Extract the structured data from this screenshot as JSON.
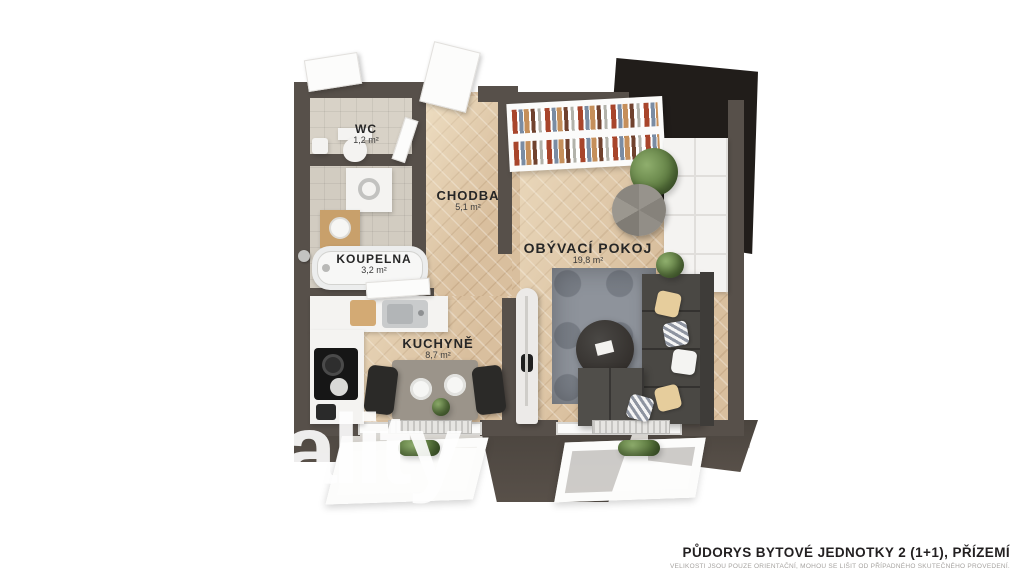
{
  "plan": {
    "watermark": "ality",
    "rooms": [
      {
        "name": "WC",
        "area": "1,2 m²"
      },
      {
        "name": "KOUPELNA",
        "area": "3,2 m²"
      },
      {
        "name": "CHODBA",
        "area": "5,1 m²"
      },
      {
        "name": "OBÝVACÍ POKOJ",
        "area": "19,8 m²"
      },
      {
        "name": "KUCHYNĚ",
        "area": "8,7 m²"
      }
    ]
  },
  "footer": {
    "title": "PŮDORYS BYTOVÉ JEDNOTKY 2 (1+1), PŘÍZEMÍ",
    "disclaimer": "VELIKOSTI JSOU POUZE ORIENTAČNÍ, MOHOU SE LIŠIT OD PŘÍPADNÉHO SKUTEČNÉHO PROVEDENÍ."
  },
  "colors": {
    "wall": "#57504a",
    "wall_dark": "#211d1a",
    "floor_wood": "#d9bf9e",
    "floor_tile": "#d2ccc1",
    "rug": "#8e939b",
    "sofa": "#4a4844",
    "plant": "#5d7b40"
  }
}
